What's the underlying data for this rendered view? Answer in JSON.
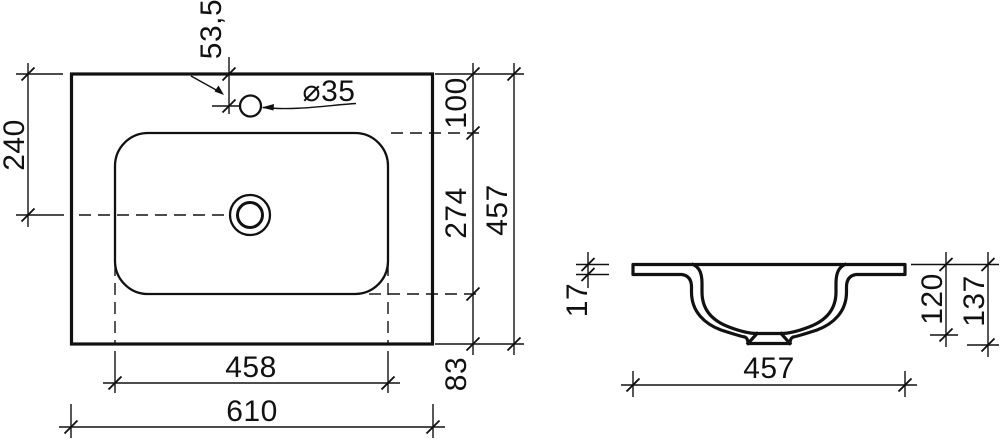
{
  "drawing": {
    "title": "washbasin-dimension-drawing",
    "colors": {
      "background": "#ffffff",
      "line": "#111111"
    },
    "top_view": {
      "dims": {
        "faucet_offset": "53,5",
        "hole_diameter": "⌀35",
        "side_to_drain": "240",
        "edge_to_basin": "100",
        "basin_front_to_back": "274",
        "overall_depth": "457",
        "basin_to_front_edge": "83",
        "basin_width": "458",
        "overall_width": "610"
      }
    },
    "section_view": {
      "dims": {
        "rim_thickness": "17",
        "bowl_depth": "120",
        "overall_height": "137",
        "bowl_width": "457"
      }
    }
  }
}
